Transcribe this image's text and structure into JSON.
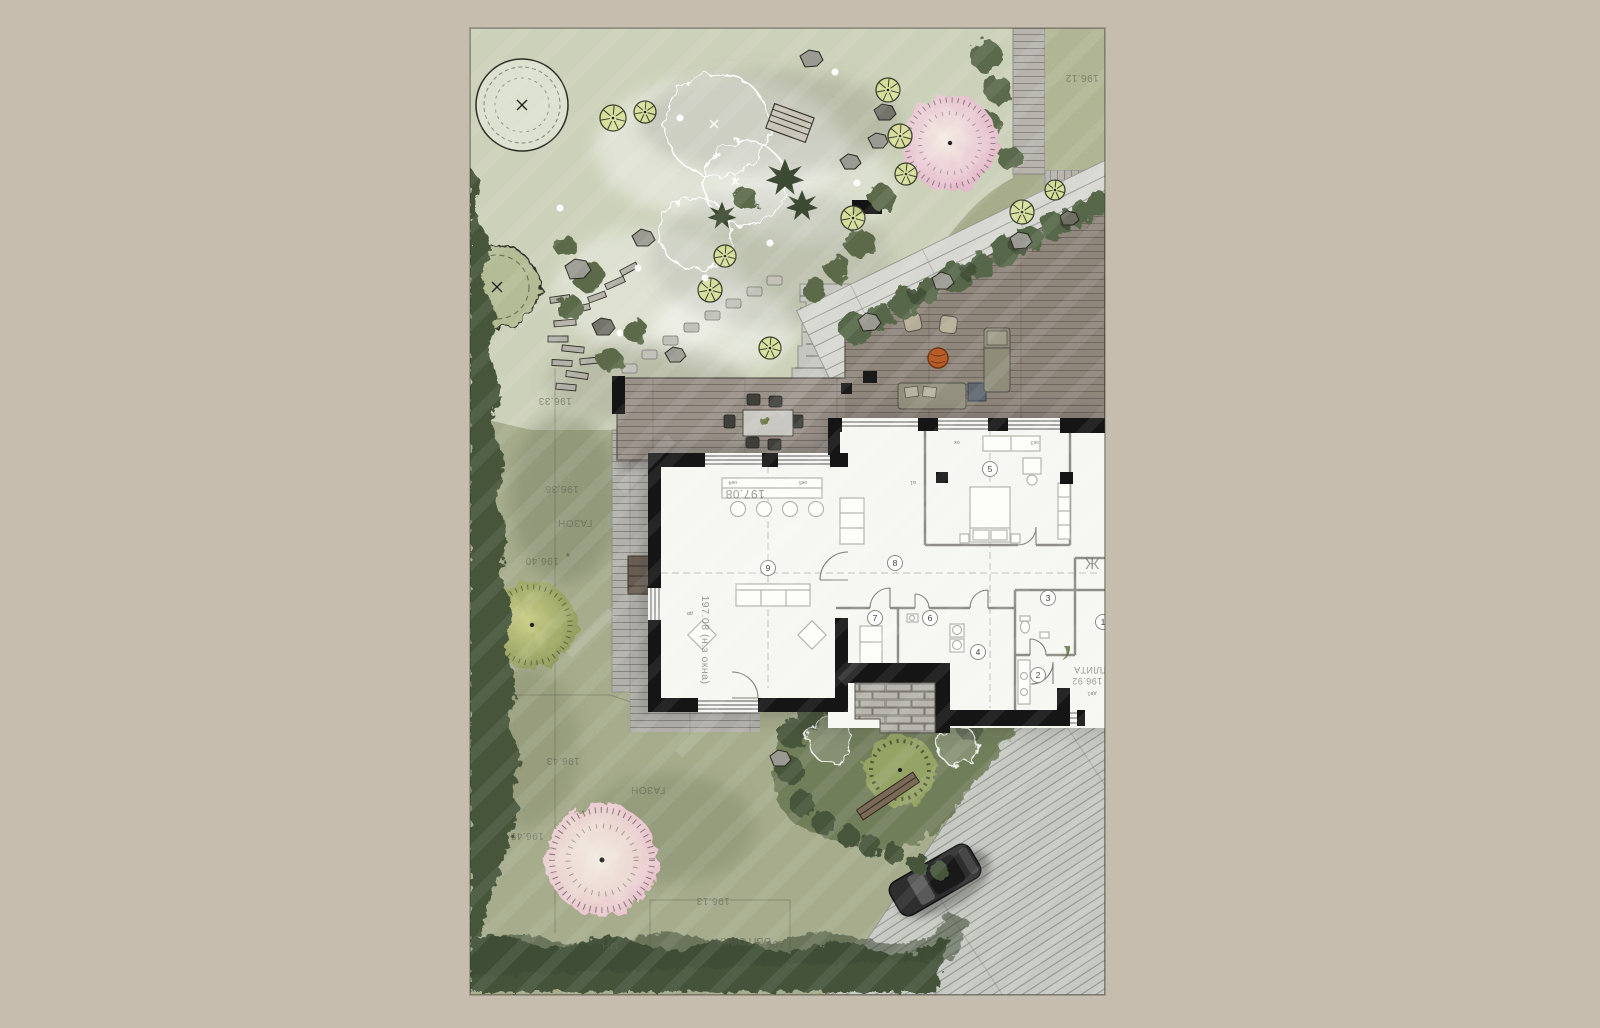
{
  "colors": {
    "page_bg": "#c6bdaf",
    "lawn": "#a9af8e",
    "garden_wash": "#cdd3bc",
    "hedge": "#46543a",
    "deck_wood": "#93897f",
    "dining_deck": "#9a9189",
    "path_gray": "#b6b4ad",
    "driveway": "#c7c9c3",
    "boardwalk": "#d7d8d2",
    "house_fill": "#f6f6f3",
    "wall_black": "#151515",
    "pink_tree": "#eac4d2",
    "firepit_orange": "#b85c28",
    "car_body": "#2e2e2e"
  },
  "site": {
    "survey_marks": [
      {
        "text": "196.12",
        "x": 612,
        "y": 47,
        "rot": 180,
        "size": 10,
        "dot": true
      },
      {
        "text": "196.33",
        "x": 85,
        "y": 370,
        "rot": 180,
        "size": 10
      },
      {
        "text": "196.36",
        "x": 92,
        "y": 458,
        "rot": 180,
        "size": 10
      },
      {
        "text": "ГАЗОН",
        "x": 105,
        "y": 492,
        "rot": 180,
        "size": 10
      },
      {
        "text": "196.40",
        "x": 72,
        "y": 530,
        "rot": 180,
        "size": 10,
        "dot": true
      },
      {
        "text": "196.43",
        "x": 93,
        "y": 730,
        "rot": 180,
        "size": 10
      },
      {
        "text": "ГАЗОН",
        "x": 178,
        "y": 759,
        "rot": 180,
        "size": 10
      },
      {
        "text": "196.45",
        "x": 57,
        "y": 805,
        "rot": 180,
        "size": 10
      },
      {
        "text": "196.13",
        "x": 243,
        "y": 870,
        "rot": 180,
        "size": 10
      },
      {
        "text": "БЫТОВКА",
        "x": 273,
        "y": 910,
        "rot": 180,
        "size": 11
      },
      {
        "text": "МН",
        "x": 140,
        "y": 914,
        "rot": 180,
        "size": 10
      },
      {
        "text": "199",
        "x": 305,
        "y": 913,
        "rot": 180,
        "size": 10
      },
      {
        "text": "ПЛИТА",
        "x": 620,
        "y": 639,
        "rot": 180,
        "size": 9
      },
      {
        "text": "196.92",
        "x": 617,
        "y": 650,
        "rot": 180,
        "size": 9
      },
      {
        "text": "Ж",
        "x": 622,
        "y": 530,
        "rot": 180,
        "size": 16
      },
      {
        "text": "197.08",
        "x": 275,
        "y": 462,
        "rot": 180,
        "size": 12
      },
      {
        "text": "197.08 (н.з окна)",
        "x": 232,
        "y": 612,
        "rot": 90,
        "size": 10.5
      }
    ],
    "light_dots": [
      {
        "x": 90,
        "y": 180
      },
      {
        "x": 150,
        "y": 305
      },
      {
        "x": 235,
        "y": 250
      },
      {
        "x": 300,
        "y": 215
      },
      {
        "x": 365,
        "y": 44
      },
      {
        "x": 387,
        "y": 155
      },
      {
        "x": 210,
        "y": 90
      },
      {
        "x": 168,
        "y": 240
      }
    ],
    "symbol_trees": [
      {
        "x": 143,
        "y": 90,
        "r": 13
      },
      {
        "x": 175,
        "y": 84,
        "r": 11
      },
      {
        "x": 418,
        "y": 62,
        "r": 12
      },
      {
        "x": 430,
        "y": 108,
        "r": 12
      },
      {
        "x": 436,
        "y": 146,
        "r": 11
      },
      {
        "x": 383,
        "y": 190,
        "r": 12
      },
      {
        "x": 255,
        "y": 228,
        "r": 11
      },
      {
        "x": 240,
        "y": 262,
        "r": 12
      },
      {
        "x": 300,
        "y": 320,
        "r": 11
      },
      {
        "x": 552,
        "y": 184,
        "r": 12
      },
      {
        "x": 585,
        "y": 162,
        "r": 10
      }
    ]
  },
  "house": {
    "rooms": [
      {
        "number": "1",
        "x": 633,
        "y": 594
      },
      {
        "number": "2",
        "x": 568,
        "y": 647
      },
      {
        "number": "3",
        "x": 578,
        "y": 570
      },
      {
        "number": "4",
        "x": 508,
        "y": 624
      },
      {
        "number": "5",
        "x": 520,
        "y": 441
      },
      {
        "number": "6",
        "x": 460,
        "y": 590
      },
      {
        "number": "7",
        "x": 405,
        "y": 590
      },
      {
        "number": "8",
        "x": 425,
        "y": 535
      },
      {
        "number": "9",
        "x": 298,
        "y": 540
      }
    ],
    "window_labels": [
      {
        "text": "ок4",
        "x": 263,
        "y": 453
      },
      {
        "text": "ок5",
        "x": 333,
        "y": 453
      },
      {
        "text": "а1",
        "x": 443,
        "y": 453
      },
      {
        "text": "ок",
        "x": 487,
        "y": 413
      },
      {
        "text": "ок3",
        "x": 565,
        "y": 413
      },
      {
        "text": "дв",
        "x": 220,
        "y": 584
      },
      {
        "text": "дв1",
        "x": 622,
        "y": 664
      }
    ]
  }
}
